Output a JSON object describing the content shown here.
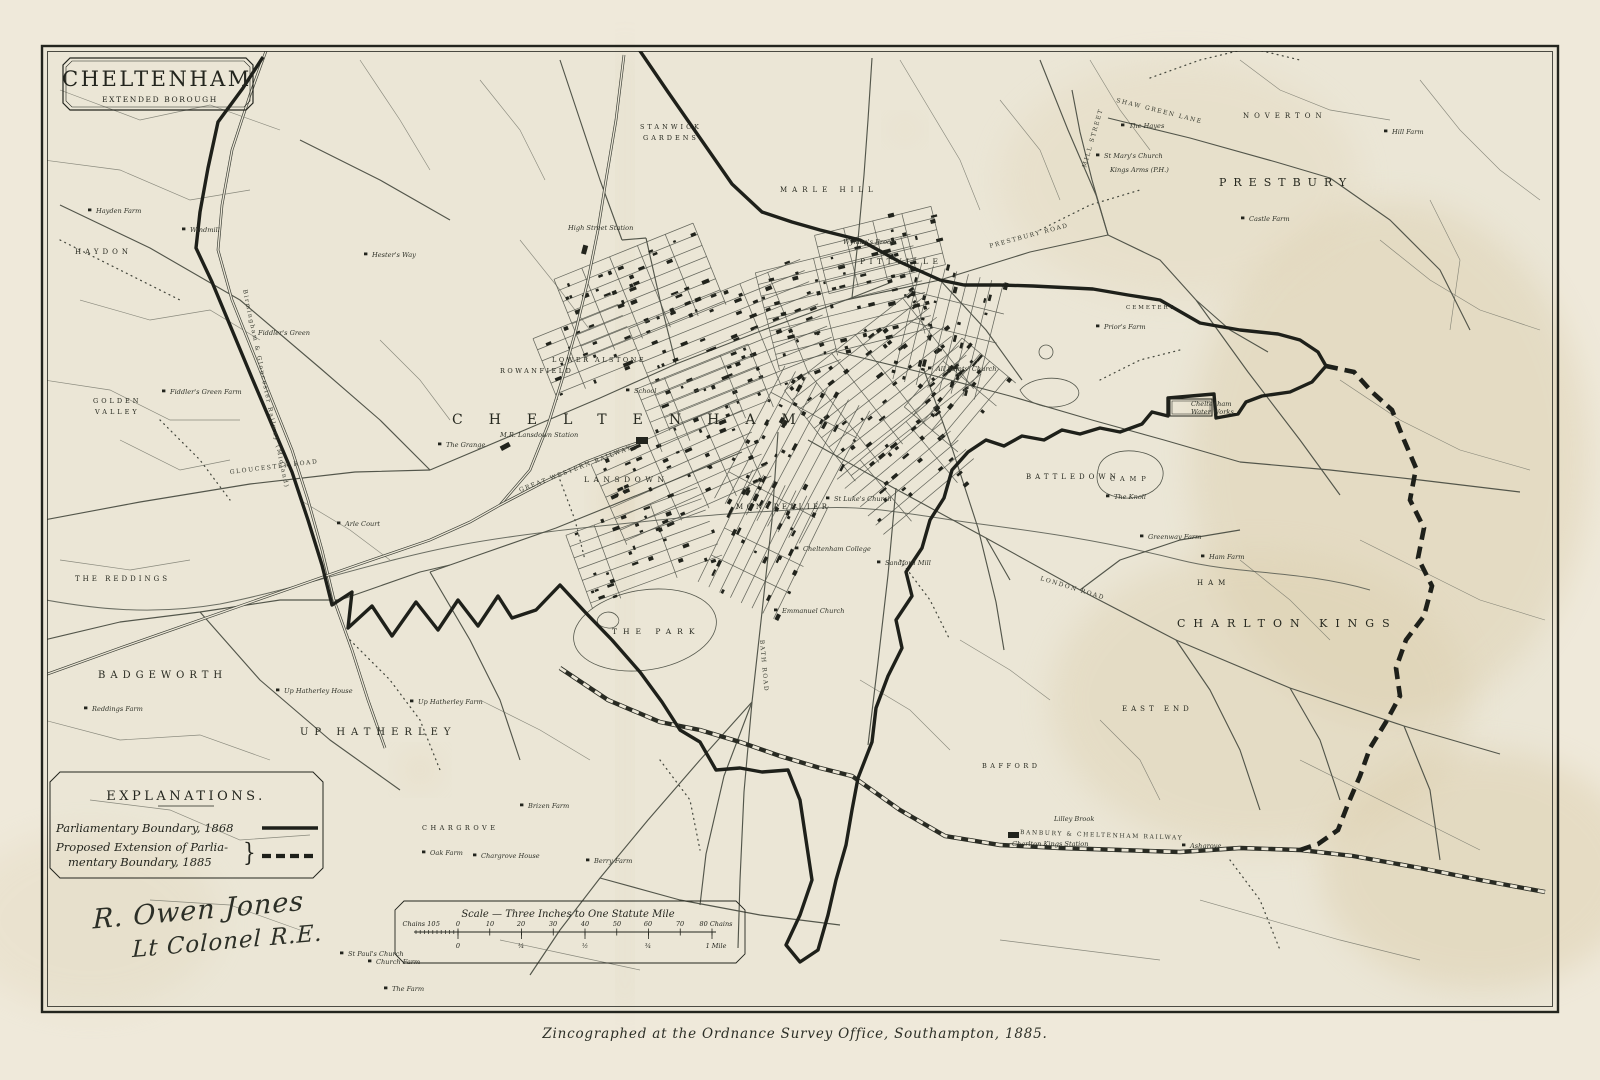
{
  "colors": {
    "paper": "#ebe6d6",
    "paper_margin": "#efe9da",
    "aged_tan": "#dccfae",
    "ink": "#3d4037",
    "boundary_ink": "#1e201a",
    "label_ink": "#26281f"
  },
  "title_box": {
    "title": "CHELTENHAM",
    "subtitle": "EXTENDED BOROUGH"
  },
  "legend": {
    "title": "EXPLANATIONS.",
    "item1_label": "Parliamentary Boundary, 1868",
    "item2_label_line1": "Proposed Extension of Parlia-",
    "item2_label_line2": "mentary Boundary, 1885",
    "bracket": "}"
  },
  "signature": {
    "line1": "R. Owen Jones",
    "line2": "Lt Colonel R.E."
  },
  "scale_bar": {
    "title": "Scale — Three Inches to One Statute Mile",
    "top_row": [
      {
        "t": "Chains 10",
        "x": 419
      },
      {
        "t": "5",
        "x": 438
      },
      {
        "t": "0",
        "x": 458
      },
      {
        "t": "10",
        "x": 490
      },
      {
        "t": "20",
        "x": 521
      },
      {
        "t": "30",
        "x": 553
      },
      {
        "t": "40",
        "x": 585
      },
      {
        "t": "50",
        "x": 617
      },
      {
        "t": "60",
        "x": 648
      },
      {
        "t": "70",
        "x": 680
      },
      {
        "t": "80 Chains",
        "x": 716
      }
    ],
    "bottom_row": [
      {
        "t": "0",
        "x": 458
      },
      {
        "t": "¼",
        "x": 521
      },
      {
        "t": "½",
        "x": 585
      },
      {
        "t": "¾",
        "x": 648
      },
      {
        "t": "1 Mile",
        "x": 716
      }
    ]
  },
  "imprint": "Zincographed at the Ordnance Survey Office, Southampton, 1885.",
  "district_labels": [
    {
      "t": "PRESTBURY",
      "x": 1219,
      "y": 186,
      "s": 11,
      "sp": 7
    },
    {
      "t": "NOVERTON",
      "x": 1243,
      "y": 118,
      "s": 7,
      "sp": 5
    },
    {
      "t": "CHARLTON KINGS",
      "x": 1177,
      "y": 627,
      "s": 11,
      "sp": 8
    },
    {
      "t": "EAST END",
      "x": 1122,
      "y": 711,
      "s": 7,
      "sp": 4
    },
    {
      "t": "HAM",
      "x": 1197,
      "y": 585,
      "s": 7,
      "sp": 5
    },
    {
      "t": "BAFFORD",
      "x": 982,
      "y": 768,
      "s": 6.5,
      "sp": 3.5
    },
    {
      "t": "BATTLEDOWN",
      "x": 1026,
      "y": 479,
      "s": 7,
      "sp": 4
    },
    {
      "t": "CAMP",
      "x": 1110,
      "y": 481,
      "s": 6.5,
      "sp": 5
    },
    {
      "t": "CEMETERY",
      "x": 1126,
      "y": 309,
      "s": 5.5,
      "sp": 2
    },
    {
      "t": "BADGEWORTH",
      "x": 98,
      "y": 678,
      "s": 10,
      "sp": 5
    },
    {
      "t": "UP HATHERLEY",
      "x": 300,
      "y": 735,
      "s": 10,
      "sp": 6
    },
    {
      "t": "THE REDDINGS",
      "x": 75,
      "y": 581,
      "s": 7,
      "sp": 3
    },
    {
      "t": "GOLDEN",
      "x": 93,
      "y": 403,
      "s": 6.5,
      "sp": 3
    },
    {
      "t": "VALLEY",
      "x": 95,
      "y": 414,
      "s": 6.5,
      "sp": 3
    },
    {
      "t": "HAYDON",
      "x": 75,
      "y": 254,
      "s": 7,
      "sp": 4
    },
    {
      "t": "CHARGROVE",
      "x": 422,
      "y": 830,
      "s": 6.5,
      "sp": 3.5
    },
    {
      "t": "CHELTENHAM",
      "x": 452,
      "y": 424,
      "s": 14,
      "sp": 26
    },
    {
      "t": "PITTVILLE",
      "x": 860,
      "y": 264,
      "s": 7.5,
      "sp": 4.5
    },
    {
      "t": "LANSDOWN",
      "x": 584,
      "y": 482,
      "s": 7.5,
      "sp": 4.5
    },
    {
      "t": "MONTPELLIER",
      "x": 736,
      "y": 509,
      "s": 7,
      "sp": 3.5
    },
    {
      "t": "ROWANFIELD",
      "x": 500,
      "y": 373,
      "s": 6.5,
      "sp": 2.5
    },
    {
      "t": "LOWER ALSTONE",
      "x": 552,
      "y": 362,
      "s": 6.5,
      "sp": 2.5
    },
    {
      "t": "STANWICK",
      "x": 640,
      "y": 129,
      "s": 6.5,
      "sp": 3
    },
    {
      "t": "GARDENS",
      "x": 643,
      "y": 140,
      "s": 6.5,
      "sp": 3
    },
    {
      "t": "MARLE HILL",
      "x": 780,
      "y": 192,
      "s": 7,
      "sp": 5
    },
    {
      "t": "THE PARK",
      "x": 612,
      "y": 634,
      "s": 7.5,
      "sp": 6
    }
  ],
  "place_labels": [
    {
      "t": "Hayden Farm",
      "x": 96,
      "y": 213,
      "m": 1
    },
    {
      "t": "Windmill",
      "x": 190,
      "y": 232,
      "m": 1
    },
    {
      "t": "Hester's Way",
      "x": 372,
      "y": 257,
      "m": 1
    },
    {
      "t": "Fiddler's Green",
      "x": 258,
      "y": 335
    },
    {
      "t": "Fiddler's Green Farm",
      "x": 170,
      "y": 394,
      "m": 1
    },
    {
      "t": "Arle Court",
      "x": 345,
      "y": 526,
      "m": 1
    },
    {
      "t": "Reddings Farm",
      "x": 92,
      "y": 711,
      "m": 1
    },
    {
      "t": "Up Hatherley House",
      "x": 284,
      "y": 693,
      "m": 1
    },
    {
      "t": "Up Hatherley Farm",
      "x": 418,
      "y": 704,
      "m": 1
    },
    {
      "t": "Oak Farm",
      "x": 430,
      "y": 855,
      "m": 1
    },
    {
      "t": "Chargrove House",
      "x": 481,
      "y": 858,
      "m": 1
    },
    {
      "t": "Berry Farm",
      "x": 594,
      "y": 863,
      "m": 1
    },
    {
      "t": "Brizen Farm",
      "x": 528,
      "y": 808,
      "m": 1
    },
    {
      "t": "St Paul's Church",
      "x": 348,
      "y": 956,
      "m": 1
    },
    {
      "t": "Church Farm",
      "x": 376,
      "y": 964,
      "m": 1
    },
    {
      "t": "The Farm",
      "x": 392,
      "y": 991,
      "m": 1
    },
    {
      "t": "High Street Station",
      "x": 568,
      "y": 230
    },
    {
      "t": "M.R. Lansdown Station",
      "x": 500,
      "y": 437
    },
    {
      "t": "The Grange",
      "x": 446,
      "y": 447,
      "m": 1
    },
    {
      "t": "School",
      "x": 634,
      "y": 393,
      "m": 1
    },
    {
      "t": "Wyman's Brook",
      "x": 843,
      "y": 244
    },
    {
      "t": "All Saints' Church",
      "x": 936,
      "y": 371,
      "m": 1
    },
    {
      "t": "Prior's Farm",
      "x": 1104,
      "y": 329,
      "m": 1
    },
    {
      "t": "The Hayes",
      "x": 1129,
      "y": 128,
      "m": 1
    },
    {
      "t": "St Mary's Church",
      "x": 1104,
      "y": 158,
      "m": 1
    },
    {
      "t": "Kings Arms (P.H.)",
      "x": 1110,
      "y": 172
    },
    {
      "t": "Hill Farm",
      "x": 1392,
      "y": 134,
      "m": 1
    },
    {
      "t": "Castle Farm",
      "x": 1249,
      "y": 221,
      "m": 1
    },
    {
      "t": "The Knoll",
      "x": 1114,
      "y": 499,
      "m": 1
    },
    {
      "t": "Greenway Farm",
      "x": 1148,
      "y": 539,
      "m": 1
    },
    {
      "t": "Ham Farm",
      "x": 1209,
      "y": 559,
      "m": 1
    },
    {
      "t": "Lilley Brook",
      "x": 1054,
      "y": 821
    },
    {
      "t": "Charlton Kings Station",
      "x": 1012,
      "y": 846
    },
    {
      "t": "Ashgrove",
      "x": 1190,
      "y": 848,
      "m": 1
    },
    {
      "t": "St Luke's Church",
      "x": 834,
      "y": 501,
      "m": 1
    },
    {
      "t": "Cheltenham College",
      "x": 803,
      "y": 551,
      "m": 1
    },
    {
      "t": "Sandford Mill",
      "x": 885,
      "y": 565,
      "m": 1
    },
    {
      "t": "Emmanuel Church",
      "x": 782,
      "y": 613,
      "m": 1
    },
    {
      "t": "Cheltenham",
      "x": 1191,
      "y": 406
    },
    {
      "t": "Water Works",
      "x": 1191,
      "y": 414
    }
  ],
  "road_labels": [
    {
      "t": "GLOUCESTER ROAD",
      "x": 230,
      "y": 474,
      "r": -7
    },
    {
      "t": "PRESTBURY ROAD",
      "x": 990,
      "y": 248,
      "r": -15
    },
    {
      "t": "SHAW GREEN LANE",
      "x": 1116,
      "y": 102,
      "r": 14
    },
    {
      "t": "MILL STREET",
      "x": 1086,
      "y": 168,
      "r": -74
    },
    {
      "t": "LONDON ROAD",
      "x": 1040,
      "y": 580,
      "r": 17
    },
    {
      "t": "BATH ROAD",
      "x": 760,
      "y": 640,
      "r": 85
    },
    {
      "t": "GREAT WESTERN RAILWAY",
      "x": 520,
      "y": 492,
      "r": -21
    },
    {
      "t": "BANBURY & CHELTENHAM RAILWAY",
      "x": 1020,
      "y": 834,
      "r": 2
    },
    {
      "t": "Birmingham & Gloucester Railway (Midland)",
      "x": 243,
      "y": 290,
      "r": 78
    }
  ]
}
